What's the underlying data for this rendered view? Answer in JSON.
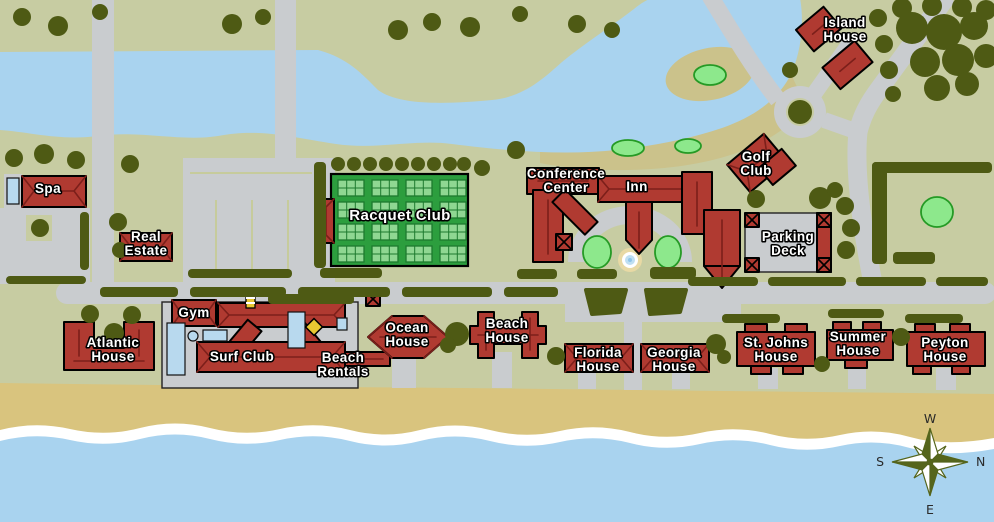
{
  "palette": {
    "land": "#c7cca2",
    "fairway": "#cbc28b",
    "water": "#a9d3ef",
    "sand": "#d9c47e",
    "foam": "#ffffff",
    "road": "#c9cccf",
    "tree": "#4e5a14",
    "bldg": "#b03a31",
    "ridge": "#7c1f1a",
    "court_bg": "#2c9e3e",
    "court_surface": "#8fd792",
    "court_line": "#1d7a2e",
    "golf_green": "#8de88c",
    "golf_green_edge": "#259a25",
    "pool": "#b8d9ee",
    "park_line": "#c6cb9c",
    "label_text": "#ffffff",
    "label_outline": "#000000",
    "compass": "#55651c"
  },
  "places": {
    "spa": {
      "lines": [
        "Spa"
      ]
    },
    "real_estate": {
      "lines": [
        "Real",
        "Estate"
      ]
    },
    "racquet_club": {
      "lines": [
        "Racquet Club"
      ]
    },
    "conference_center": {
      "lines": [
        "Conference",
        "Center"
      ]
    },
    "inn": {
      "lines": [
        "Inn"
      ]
    },
    "golf_club": {
      "lines": [
        "Golf",
        "Club"
      ]
    },
    "island_house": {
      "lines": [
        "Island",
        "House"
      ]
    },
    "parking_deck": {
      "lines": [
        "Parking",
        "Deck"
      ]
    },
    "gym": {
      "lines": [
        "Gym"
      ]
    },
    "surf_club": {
      "lines": [
        "Surf Club"
      ]
    },
    "beach_rentals": {
      "lines": [
        "Beach",
        "Rentals"
      ]
    },
    "atlantic_house": {
      "lines": [
        "Atlantic",
        "House"
      ]
    },
    "ocean_house": {
      "lines": [
        "Ocean",
        "House"
      ]
    },
    "beach_house": {
      "lines": [
        "Beach",
        "House"
      ]
    },
    "florida_house": {
      "lines": [
        "Florida",
        "House"
      ]
    },
    "georgia_house": {
      "lines": [
        "Georgia",
        "House"
      ]
    },
    "st_johns_house": {
      "lines": [
        "St. Johns",
        "House"
      ]
    },
    "summer_house": {
      "lines": [
        "Summer",
        "House"
      ]
    },
    "peyton_house": {
      "lines": [
        "Peyton",
        "House"
      ]
    }
  },
  "compass": {
    "north": "N",
    "south": "S",
    "east": "E",
    "west": "W"
  }
}
